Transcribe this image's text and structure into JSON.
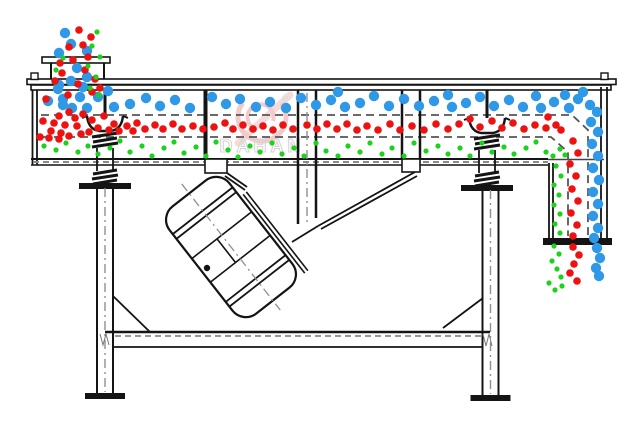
{
  "diagram": {
    "watermark": {
      "brand": "DAHAN",
      "registered": "®"
    },
    "colors": {
      "coarse_particles_blue": "#2f99e8",
      "medium_particles_red": "#ee1111",
      "fine_particles_green": "#1dd21d",
      "structure_lines": "#141414",
      "screen_mesh_dash": "#555555",
      "watermark_red": "#e8a0a0",
      "watermark_gray": "#b3b3b3"
    },
    "particles": {
      "blue": {
        "color": "#2f99e8",
        "radius": 5.2,
        "points": [
          [
            65,
            33
          ],
          [
            71,
            44
          ],
          [
            87,
            51
          ],
          [
            59,
            53
          ],
          [
            77,
            68
          ],
          [
            87,
            77
          ],
          [
            71,
            81
          ],
          [
            59,
            85
          ],
          [
            83,
            87
          ],
          [
            58,
            89
          ],
          [
            63,
            99
          ],
          [
            80,
            97
          ],
          [
            48,
            101
          ],
          [
            63,
            105
          ],
          [
            72,
            108
          ],
          [
            87,
            108
          ],
          [
            98,
            97
          ],
          [
            108,
            91
          ],
          [
            114,
            107
          ],
          [
            130,
            104
          ],
          [
            146,
            98
          ],
          [
            160,
            106
          ],
          [
            175,
            100
          ],
          [
            190,
            108
          ],
          [
            212,
            97
          ],
          [
            226,
            104
          ],
          [
            240,
            99
          ],
          [
            256,
            107
          ],
          [
            270,
            102
          ],
          [
            286,
            108
          ],
          [
            301,
            98
          ],
          [
            316,
            105
          ],
          [
            331,
            100
          ],
          [
            338,
            92
          ],
          [
            345,
            107
          ],
          [
            360,
            103
          ],
          [
            374,
            96
          ],
          [
            389,
            106
          ],
          [
            404,
            99
          ],
          [
            419,
            106
          ],
          [
            434,
            101
          ],
          [
            448,
            95
          ],
          [
            452,
            107
          ],
          [
            466,
            103
          ],
          [
            480,
            97
          ],
          [
            494,
            106
          ],
          [
            509,
            100
          ],
          [
            523,
            107
          ],
          [
            536,
            96
          ],
          [
            541,
            108
          ],
          [
            554,
            102
          ],
          [
            565,
            95
          ],
          [
            569,
            108
          ],
          [
            578,
            99
          ],
          [
            583,
            92
          ],
          [
            590,
            105
          ],
          [
            597,
            112
          ],
          [
            591,
            122
          ],
          [
            598,
            132
          ],
          [
            592,
            144
          ],
          [
            598,
            156
          ],
          [
            593,
            168
          ],
          [
            599,
            180
          ],
          [
            593,
            192
          ],
          [
            598,
            204
          ],
          [
            593,
            216
          ],
          [
            598,
            228
          ],
          [
            594,
            238
          ],
          [
            597,
            248
          ],
          [
            600,
            258
          ],
          [
            596,
            268
          ],
          [
            599,
            276
          ]
        ]
      },
      "red": {
        "color": "#ee1111",
        "radius": 3.8,
        "points": [
          [
            79,
            30
          ],
          [
            91,
            37
          ],
          [
            83,
            45
          ],
          [
            69,
            47
          ],
          [
            88,
            57
          ],
          [
            73,
            60
          ],
          [
            60,
            63
          ],
          [
            85,
            70
          ],
          [
            95,
            79
          ],
          [
            62,
            73
          ],
          [
            78,
            84
          ],
          [
            92,
            92
          ],
          [
            55,
            81
          ],
          [
            68,
            95
          ],
          [
            100,
            88
          ],
          [
            46,
            99
          ],
          [
            59,
            116
          ],
          [
            69,
            112
          ],
          [
            75,
            118
          ],
          [
            83,
            114
          ],
          [
            92,
            120
          ],
          [
            104,
            116
          ],
          [
            43,
            121
          ],
          [
            54,
            123
          ],
          [
            65,
            125
          ],
          [
            77,
            126
          ],
          [
            51,
            131
          ],
          [
            61,
            133
          ],
          [
            40,
            137
          ],
          [
            49,
            138
          ],
          [
            59,
            139
          ],
          [
            69,
            136
          ],
          [
            81,
            134
          ],
          [
            89,
            132
          ],
          [
            98,
            128
          ],
          [
            109,
            130
          ],
          [
            114,
            124
          ],
          [
            119,
            131
          ],
          [
            127,
            126
          ],
          [
            133,
            131
          ],
          [
            137,
            123
          ],
          [
            145,
            129
          ],
          [
            155,
            125
          ],
          [
            163,
            129
          ],
          [
            173,
            124
          ],
          [
            182,
            129
          ],
          [
            193,
            126
          ],
          [
            203,
            129
          ],
          [
            214,
            127
          ],
          [
            225,
            123
          ],
          [
            233,
            129
          ],
          [
            243,
            125
          ],
          [
            253,
            129
          ],
          [
            263,
            126
          ],
          [
            273,
            130
          ],
          [
            283,
            125
          ],
          [
            293,
            129
          ],
          [
            307,
            125
          ],
          [
            317,
            129
          ],
          [
            327,
            124
          ],
          [
            337,
            129
          ],
          [
            347,
            124
          ],
          [
            357,
            130
          ],
          [
            367,
            126
          ],
          [
            378,
            130
          ],
          [
            390,
            124
          ],
          [
            400,
            130
          ],
          [
            412,
            126
          ],
          [
            424,
            130
          ],
          [
            436,
            124
          ],
          [
            448,
            129
          ],
          [
            459,
            124
          ],
          [
            470,
            119
          ],
          [
            480,
            127
          ],
          [
            492,
            121
          ],
          [
            502,
            128
          ],
          [
            513,
            123
          ],
          [
            524,
            129
          ],
          [
            535,
            125
          ],
          [
            546,
            128
          ],
          [
            556,
            125
          ],
          [
            548,
            117
          ],
          [
            561,
            130
          ],
          [
            573,
            141
          ],
          [
            578,
            153
          ],
          [
            570,
            164
          ],
          [
            576,
            176
          ],
          [
            572,
            189
          ],
          [
            578,
            201
          ],
          [
            571,
            213
          ],
          [
            577,
            225
          ],
          [
            573,
            236
          ],
          [
            573,
            247
          ],
          [
            579,
            255
          ],
          [
            574,
            264
          ],
          [
            570,
            273
          ],
          [
            577,
            281
          ]
        ]
      },
      "green": {
        "color": "#1dd21d",
        "radius": 2.6,
        "points": [
          [
            97,
            32
          ],
          [
            92,
            46
          ],
          [
            100,
            57
          ],
          [
            88,
            66
          ],
          [
            96,
            77
          ],
          [
            90,
            88
          ],
          [
            63,
            58
          ],
          [
            56,
            70
          ],
          [
            99,
            95
          ],
          [
            44,
            146
          ],
          [
            56,
            150
          ],
          [
            66,
            143
          ],
          [
            78,
            152
          ],
          [
            88,
            146
          ],
          [
            98,
            154
          ],
          [
            110,
            148
          ],
          [
            120,
            141
          ],
          [
            130,
            152
          ],
          [
            142,
            146
          ],
          [
            152,
            156
          ],
          [
            164,
            148
          ],
          [
            174,
            142
          ],
          [
            184,
            153
          ],
          [
            196,
            147
          ],
          [
            206,
            156
          ],
          [
            216,
            142
          ],
          [
            228,
            150
          ],
          [
            238,
            157
          ],
          [
            250,
            146
          ],
          [
            260,
            152
          ],
          [
            272,
            143
          ],
          [
            282,
            154
          ],
          [
            294,
            148
          ],
          [
            304,
            156
          ],
          [
            316,
            143
          ],
          [
            326,
            151
          ],
          [
            338,
            156
          ],
          [
            348,
            146
          ],
          [
            360,
            152
          ],
          [
            370,
            143
          ],
          [
            382,
            154
          ],
          [
            392,
            148
          ],
          [
            404,
            156
          ],
          [
            414,
            143
          ],
          [
            426,
            151
          ],
          [
            438,
            146
          ],
          [
            448,
            154
          ],
          [
            460,
            148
          ],
          [
            470,
            156
          ],
          [
            482,
            143
          ],
          [
            492,
            152
          ],
          [
            504,
            147
          ],
          [
            514,
            154
          ],
          [
            526,
            148
          ],
          [
            536,
            142
          ],
          [
            546,
            152
          ],
          [
            553,
            156
          ],
          [
            560,
            149
          ],
          [
            565,
            155
          ],
          [
            556,
            166
          ],
          [
            561,
            176
          ],
          [
            554,
            185
          ],
          [
            559,
            195
          ],
          [
            554,
            205
          ],
          [
            560,
            214
          ],
          [
            555,
            224
          ],
          [
            560,
            233
          ],
          [
            554,
            246
          ],
          [
            559,
            254
          ],
          [
            552,
            261
          ],
          [
            557,
            269
          ],
          [
            561,
            277
          ],
          [
            549,
            283
          ],
          [
            555,
            290
          ],
          [
            562,
            286
          ]
        ]
      }
    }
  }
}
